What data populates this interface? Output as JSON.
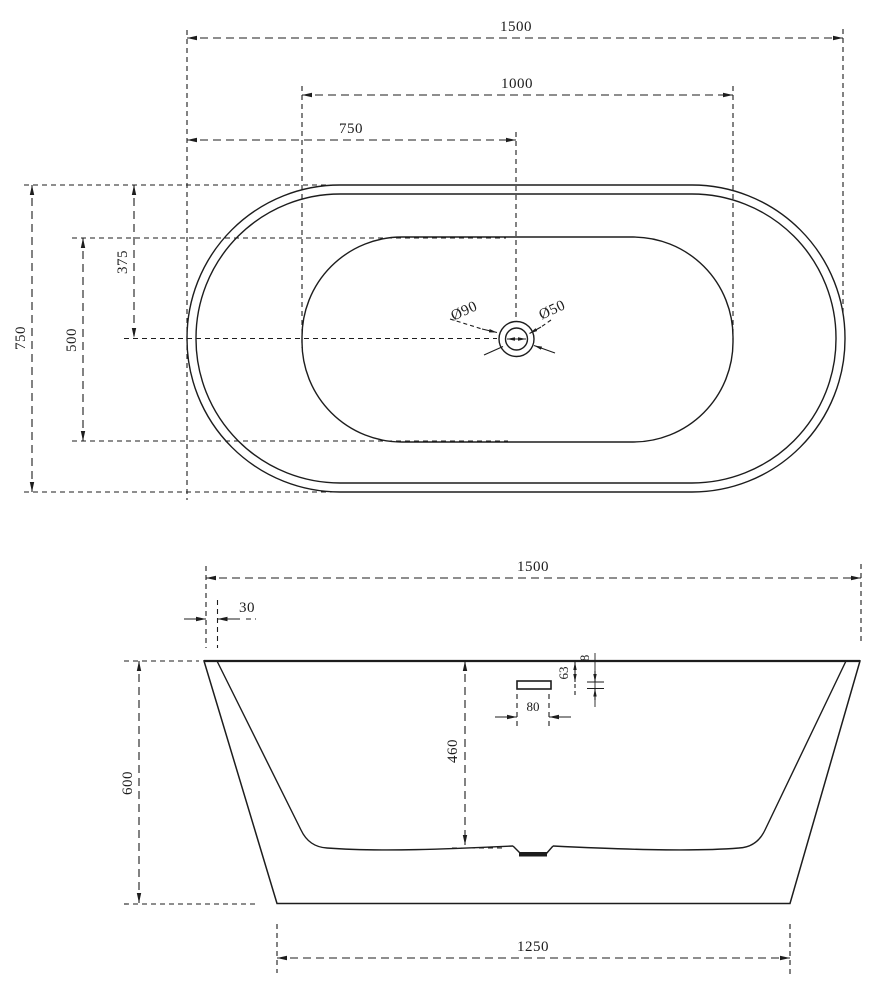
{
  "page": {
    "background": "#ffffff",
    "line_color": "#1d1d1d",
    "drawing_type": "bathtub technical drawing, top view and front elevation"
  },
  "top_view": {
    "length_overall": "1500",
    "length_inner_basin": "1000",
    "length_to_drain_center": "750",
    "width_overall": "750",
    "width_inner_basin": "500",
    "width_to_drain_center": "375",
    "drain_outer_diameter": "Ø90",
    "drain_inner_diameter": "Ø50"
  },
  "side_view": {
    "length_overall": "1500",
    "rim_lip_offset": "30",
    "height_overall": "600",
    "depth_inner": "460",
    "overflow_offset_from_top": "63",
    "overflow_slot_height": "8",
    "overflow_slot_width": "80",
    "base_length": "1250"
  }
}
